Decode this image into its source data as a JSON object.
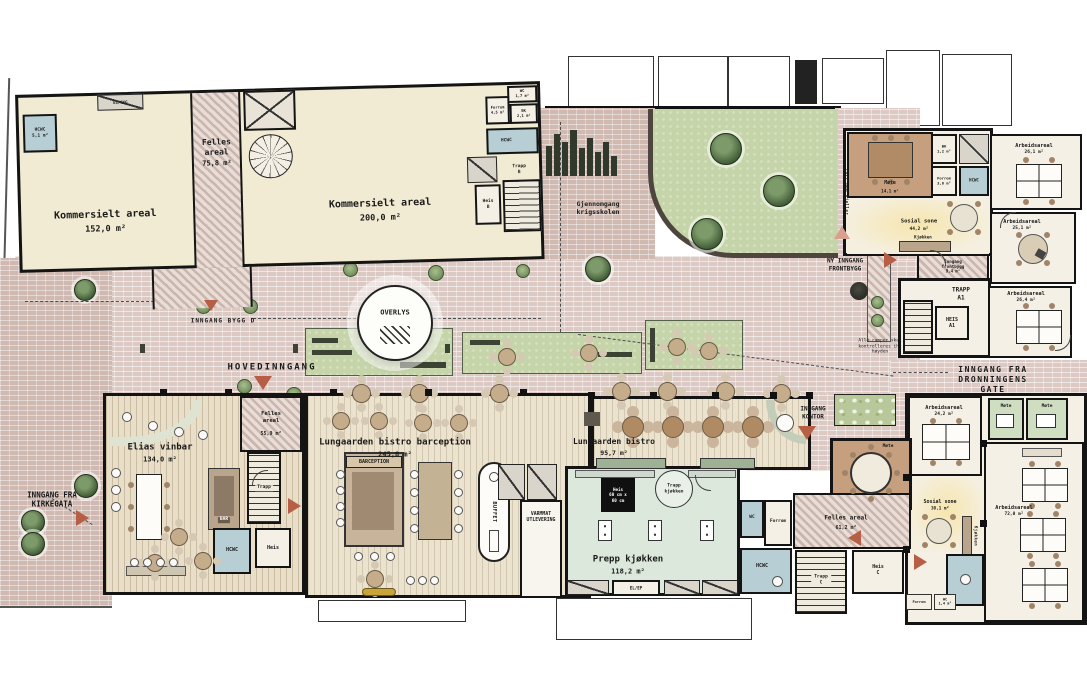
{
  "plan": {
    "labels": {
      "hovedinngang": "HOVEDINNGANG",
      "inngang_bygg_d": "INNGANG BYGG D",
      "kirkegata": "INNGANG FRA\nKIRKEGATA",
      "ny_inngang_frontbygg": "NY INNGANG\nFRONTBYGG",
      "dronningens": "INNGANG FRA DRONNINGENS GATE",
      "inngang_kontor": "INNGANG\nKONTOR",
      "gjennomgang": "Gjennomgang\nkrigsskolen",
      "overlys": "OVERLYS",
      "note_ramper": "Alle ramper skal\nkontrolleres iht\nhøyden",
      "luft_opp_kjeller": "Luft opp kjeller",
      "varmmat": "VARMMAT\nUTLEVERING",
      "buffet": "BUFFET",
      "bar": "BAR",
      "barception": "BARCEPTION"
    },
    "rooms": {
      "kommersielt1": {
        "name": "Kommersielt areal",
        "area": "152,0 m²"
      },
      "kommersielt2": {
        "name": "Kommersielt areal",
        "area": "200,0 m²"
      },
      "felles1": {
        "name": "Felles\nareal",
        "area": "75,8 m²"
      },
      "felles2": {
        "name": "Felles\nareal",
        "area": "55,9 m²"
      },
      "felles3": {
        "name": "Felles areal",
        "area": "61,2 m²"
      },
      "elias": {
        "name": "Elias vinbar",
        "area": "134,0 m²"
      },
      "barception_room": {
        "name": "Lungaarden bistro barception",
        "area": "245,8 m²"
      },
      "bistro": {
        "name": "Lungaarden bistro",
        "area": "95,7 m²"
      },
      "prepp": {
        "name": "Prepp kjøkken",
        "area": "118,2 m²"
      },
      "mote_front": {
        "name": "Møte",
        "area": "14,1 m²"
      },
      "mote_rund": {
        "name": "Møte"
      },
      "mote_1": {
        "name": "Møte"
      },
      "mote_2": {
        "name": "Møte"
      },
      "sosial_front": {
        "name": "Sosial sone",
        "area": "44,2 m²"
      },
      "sosial_kontor": {
        "name": "Sosial sone",
        "area": "30,1 m²"
      },
      "kjokken": "Kjøkken",
      "inngang_frontbygg": {
        "name": "Inngang frontbygg",
        "area": "9,4 m²"
      },
      "arb_26_1": {
        "name": "Arbeidsareal",
        "area": "26,1 m²"
      },
      "arb_25_1": {
        "name": "Arbeidsareal",
        "area": "25,1 m²"
      },
      "arb_26_4": {
        "name": "Arbeidsareal",
        "area": "26,4 m²"
      },
      "arb_24_2": {
        "name": "Arbeidsareal",
        "area": "24,2 m²"
      },
      "arb_72_0": {
        "name": "Arbeidsareal",
        "area": "72,0 m²"
      },
      "trapp_a1": "TRAPP\nA1",
      "heis_a1": "HEIS\nA1",
      "trapp_b": "Trapp\nB",
      "heis_b": "Heis\nB",
      "trapp_c": "Trapp\nC",
      "heis_c": "Heis\nC",
      "trapp": "Trapp",
      "heis": "Heis",
      "trapp_kjokken": "Trapp\nkjøkken",
      "heis_kjokken": "Heis\n60 cm x\n60 cm",
      "hcwc": "HCWC",
      "hcwc_51": "HCWC\n5,1 m²",
      "wc": "WC",
      "wc_17": "WC\n1,7 m²",
      "wc_14": "WC\n1,4 m²",
      "forrom": "Forrom",
      "forrom_45": "Forrom\n4,5 m²",
      "forrom_36": "Forrom\n3,6 m²",
      "bk_21": "BK\n2,1 m²",
      "bk_12": "BK\n1,2 m²",
      "el": "EL/EKG",
      "el_ep": "EL/EP"
    }
  }
}
